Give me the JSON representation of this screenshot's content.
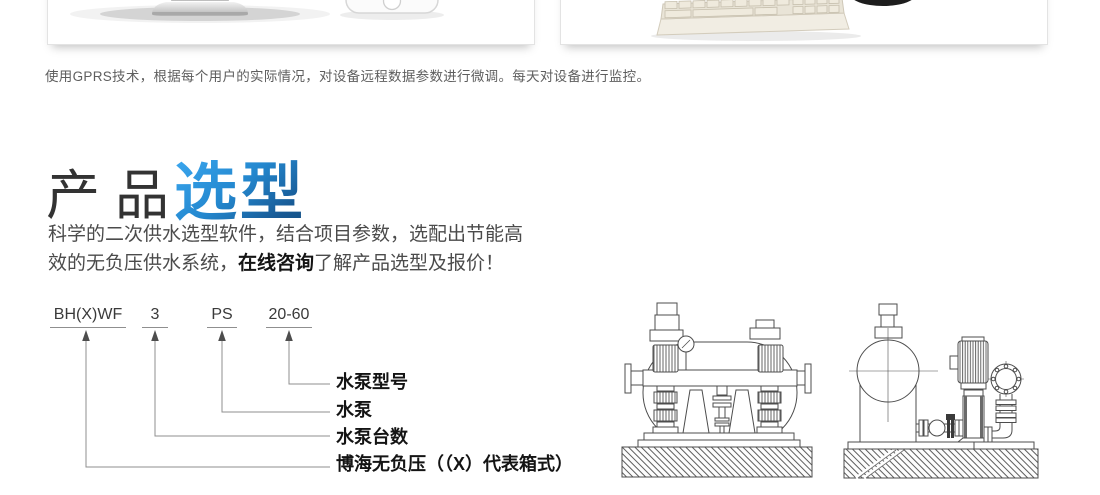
{
  "gprs_note": "使用GPRS技术，根据每个用户的实际情况，对设备远程数据参数进行微调。每天对设备进行监控。",
  "section_title": {
    "gray_part": "产品",
    "blue_part": "选型",
    "accent_light": "#3aa6ee",
    "accent_dark": "#144d7f"
  },
  "intro": {
    "line1": "科学的二次供水选型软件，结合项目参数，选配出节能高",
    "line2_pre": "效的无负压供水系统，",
    "consult_link": "在线咨询",
    "line2_post": "了解产品选型及报价！"
  },
  "model": {
    "code": [
      "BH(X)WF",
      "3",
      "PS",
      "20-60"
    ],
    "labels": [
      "水泵型号",
      "水泵",
      "水泵台数",
      "博海无负压（（X）代表箱式）"
    ]
  },
  "figures": {
    "card_left": [
      "monitor-stand",
      "smartphone"
    ],
    "card_right": [
      "keyboard",
      "mouse"
    ],
    "drawing_left": "pump-tank-unit-front-view",
    "drawing_right": "pump-tank-unit-side-view"
  }
}
